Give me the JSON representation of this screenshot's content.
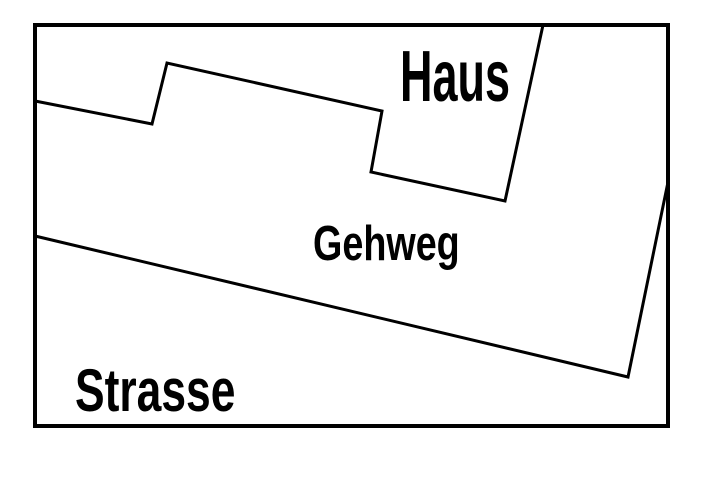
{
  "figure": {
    "background_color": "#ffffff",
    "line_color": "#000000",
    "text_color": "#000000",
    "labels": {
      "house": "Haus",
      "sidewalk": "Gehweg",
      "street": "Strasse"
    }
  }
}
